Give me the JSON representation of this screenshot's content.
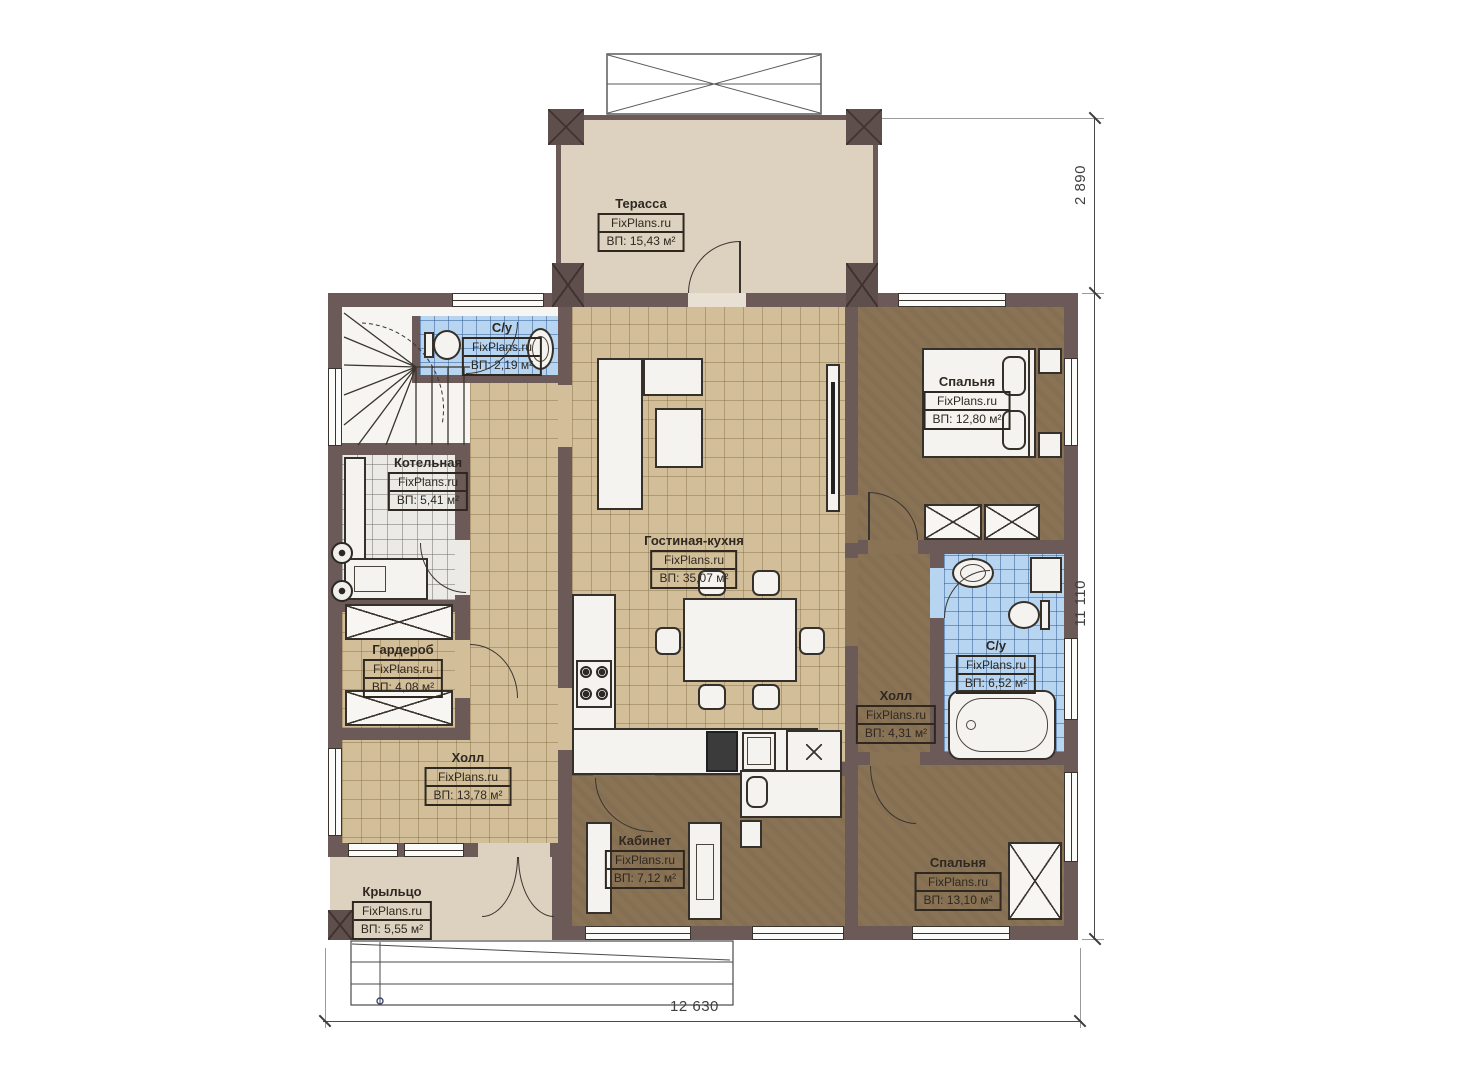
{
  "brand": "FixPlans.ru",
  "rooms": [
    {
      "id": "terrace",
      "name": "Терасса",
      "area": "ВП: 15,43 м²"
    },
    {
      "id": "wc_small",
      "name": "С/у",
      "area": "ВП: 2,19 м²"
    },
    {
      "id": "bedroom1",
      "name": "Спальня",
      "area": "ВП: 12,80 м²"
    },
    {
      "id": "boiler",
      "name": "Котельная",
      "area": "ВП: 5,41 м²"
    },
    {
      "id": "living",
      "name": "Гостиная-кухня",
      "area": "ВП: 35,07 м²"
    },
    {
      "id": "wardrobe",
      "name": "Гардероб",
      "area": "ВП: 4,08 м²"
    },
    {
      "id": "hall_left",
      "name": "Холл",
      "area": "ВП: 13,78 м²"
    },
    {
      "id": "bath",
      "name": "С/у",
      "area": "ВП: 6,52 м²"
    },
    {
      "id": "hall_right",
      "name": "Холл",
      "area": "ВП: 4,31 м²"
    },
    {
      "id": "office",
      "name": "Кабинет",
      "area": "ВП: 7,12 м²"
    },
    {
      "id": "bedroom2",
      "name": "Спальня",
      "area": "ВП: 13,10 м²"
    },
    {
      "id": "porch",
      "name": "Крыльцо",
      "area": "ВП: 5,55 м²"
    }
  ],
  "dimensions": {
    "terrace_depth": "2 890",
    "house_side": "11 110",
    "house_width": "12 630"
  },
  "colors": {
    "wall": "#6b5a57",
    "terrace": "#ddd2c0",
    "tile_beige": "#d2bf9a",
    "floor_brown": "#8a7355",
    "tile_blue": "#b7d5f1",
    "tile_gray": "#eceae7"
  }
}
